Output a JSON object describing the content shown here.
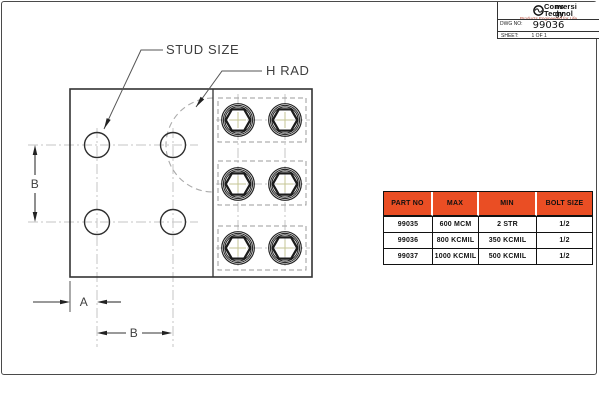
{
  "title_block": {
    "logo": {
      "line1_left": "Conversi",
      "line1_right": "ns",
      "line2_left": "Technol",
      "line2_right": "gy",
      "tagline": "Products Engineered for Life",
      "icon": "conversion-wave-circle-icon"
    },
    "dwg_no_label": "DWG NO:",
    "dwg_no_value": "99036",
    "sheet_label": "SHEET:",
    "sheet_value": "1 OF 1"
  },
  "drawing": {
    "labels": {
      "stud_size": "STUD SIZE",
      "h_rad": "H RAD",
      "dim_a": "A",
      "dim_b_vertical": "B",
      "dim_b_horizontal": "B"
    },
    "features": {
      "stud_holes": 4,
      "hex_bolts": 6
    }
  },
  "table": {
    "headers": [
      "PART NO",
      "MAX",
      "MIN",
      "BOLT SIZE"
    ],
    "rows": [
      [
        "99035",
        "600 MCM",
        "2 STR",
        "1/2"
      ],
      [
        "99036",
        "800 KCMIL",
        "350 KCMIL",
        "1/2"
      ],
      [
        "99037",
        "1000 KCMIL",
        "500 KCMIL",
        "1/2"
      ]
    ],
    "header_bg": "#ea4e24"
  },
  "colors": {
    "accent_orange": "#ea4e24",
    "tagline_red": "#b03d2a",
    "line": "#333333",
    "centerline": "#c6c6c6",
    "hidden_line": "#9b9b9b",
    "bolt_cross": "#c6c694"
  }
}
